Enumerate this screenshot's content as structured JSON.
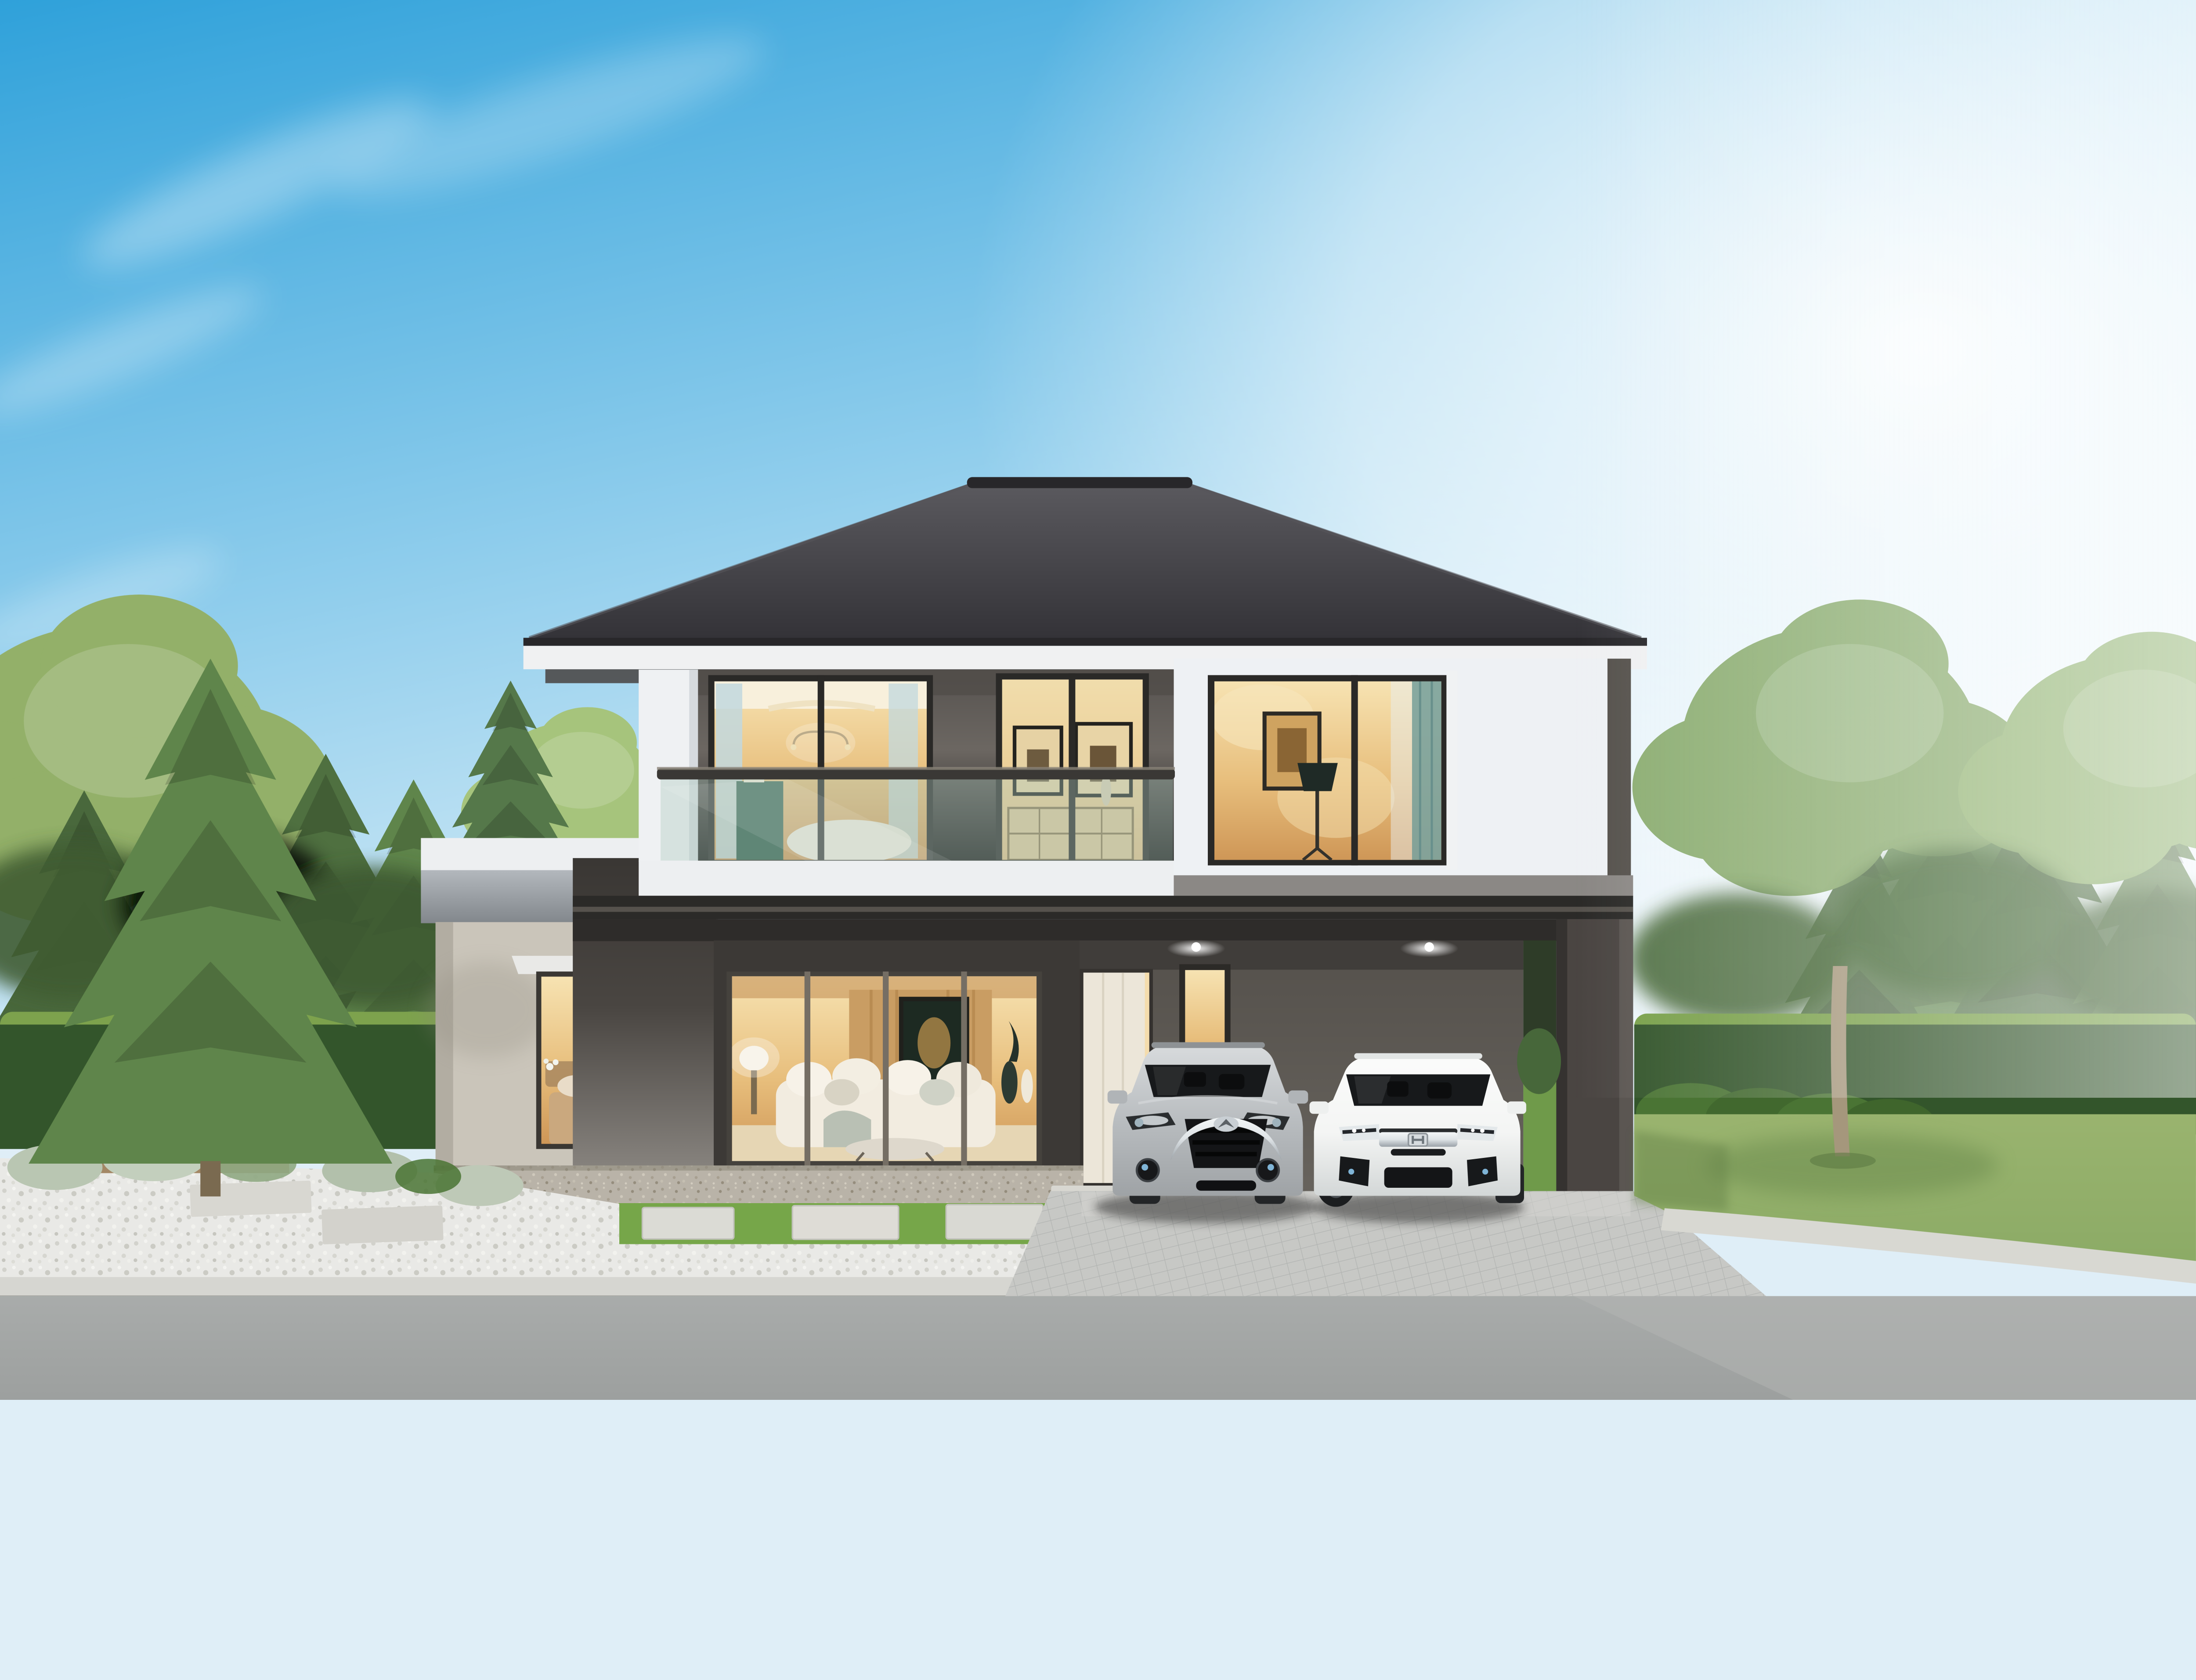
{
  "meta": {
    "type": "natural-image",
    "subject": "3D exterior rendering of a modern two-story detached house, daytime",
    "camera": "front elevation view from the street"
  },
  "palette": {
    "sky_top": "#2fa1da",
    "sky_mid": "#8fcdec",
    "sky_low": "#e4f2f9",
    "sun_glow": "#ffffff",
    "roof_top": "#5b5a5f",
    "roof_bottom": "#343338",
    "roof_edge": "#28272a",
    "fascia": "#f0f1f2",
    "soffit_shadow": "#4a4745",
    "wall_upper": "#6c6762",
    "wall_white": "#eef1f4",
    "wall_white_shade": "#c9cfd9",
    "white_pier": "#eff1f3",
    "wall_wing": "#cac5ba",
    "wing_fascia_top": "#b3b8bd",
    "wing_fascia_bottom": "#82878c",
    "parapet": "#edeff1",
    "beam": "#2b2a28",
    "pylon": "#4a4542",
    "carport_wall": "#67635d",
    "ground_wall_dark": "#3c3936",
    "wall_piece_light": "#8f8b86",
    "frame_dark": "#2a2927",
    "frame_gray": "#756e64",
    "glass_warm_top": "#f7e3b2",
    "glass_warm_mid": "#e8bf7d",
    "glass_warm_deep": "#cf9757",
    "curtain_blue": "#c2d8de",
    "curtain_teal": "#7ba39e",
    "door_cream": "#ece6d9",
    "handrail": "#3a3835",
    "glass_tint": "rgba(173,203,191,0.38)",
    "car_silver": "#b9bdc0",
    "car_silver_dark": "#9fa3a6",
    "car_white": "#f4f5f4",
    "car_glass": "#17191b",
    "chrome": "#dfe4e7",
    "grille": "#141517",
    "tire": "#232527",
    "lawn": "#8cab66",
    "lawn_shade": "#6d8d4f",
    "hedge": "#33552b",
    "hedge_top": "#7da24d",
    "pine_mid": "#5f854b",
    "pine_dark": "#49683c",
    "tree_green": "#7da25c",
    "tree_light": "#a6c47c",
    "trunk": "#a5977c",
    "shrub_silver": "#b9c6b2",
    "shrub_fern": "#4a7434",
    "gravel": "#e9e9e6",
    "paver": "#5e5f5d",
    "aggregate": "#b9b3a8",
    "walk_slab": "#d8d7d1",
    "grass": "#76a649",
    "stone": "#dbdbd5",
    "drive_tile": "#c7c8c5",
    "curb": "#d6d6d1",
    "road": "#9da09f",
    "road_shadow": "#5f6563",
    "glow_warm": "#f6d9a0"
  },
  "scene": {
    "sky_label": "blue sky with wispy clouds and bright sun glow at right",
    "house_label": "modern two-story house with dark hip roof, glass balcony and double carport",
    "roof_label": "dark gray tiled hip roof with white fascia",
    "balcony_label": "glass-railing balcony with two lit sliding windows",
    "window_a_label": "sliding door with chandelier and blue curtains",
    "window_b_label": "sliding window with two framed pictures and dresser",
    "upper_right_label": "white volume with lit corner window, floor lamp and framed art",
    "left_wing_label": "single-story wing with roof-deck railing and lit bedroom window",
    "living_window_label": "living room picture window with white sofa",
    "door_label": "cream entrance door",
    "side_window_label": "narrow lit entry window",
    "carport_label": "carport with two ceiling downlights, dark beam and support pylon",
    "car_silver_label": "silver Mazda crossover, front view",
    "car_white_label": "white Honda sedan, front view",
    "landscape_left_label": "conifer trees, hedge wall, white gravel bed with dark diagonal pavers and walkway slabs",
    "landscape_center_label": "aggregate apron, grass strip with stepping stones, gravel bed with small conifers",
    "landscape_right_label": "lawn with young tree, shrub rows, trimmed hedge and low hedge along curved curb",
    "foreground_label": "tiled driveway apron and asphalt road with dappled tree shadows"
  }
}
